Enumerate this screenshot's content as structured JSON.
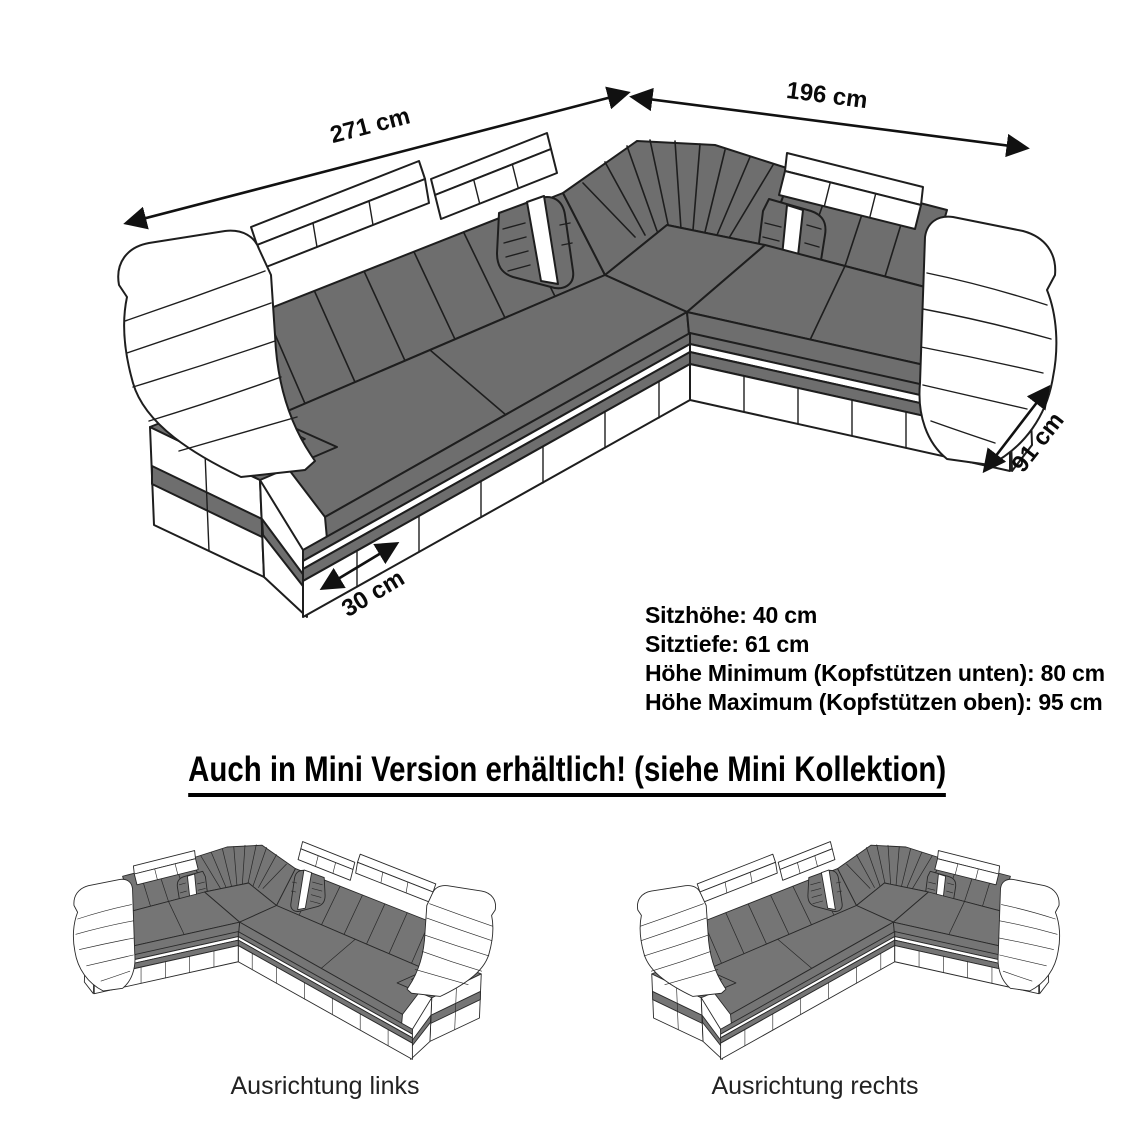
{
  "dimensions": {
    "top_left": "271 cm",
    "top_right": "196 cm",
    "depth_right": "91 cm",
    "base_bottom": "30 cm"
  },
  "specs": {
    "seat_height": "Sitzhöhe: 40 cm",
    "seat_depth": "Sitztiefe: 61 cm",
    "height_min": "Höhe Minimum (Kopfstützen unten): 80 cm",
    "height_max": "Höhe Maximum (Kopfstützen oben): 95 cm"
  },
  "headline": "Auch in Mini Version erhältlich! (siehe Mini Kollektion)",
  "variants": {
    "left": "Ausrichtung links",
    "right": "Ausrichtung rechts"
  },
  "colors": {
    "upholstery_gray": "#6e6e6e",
    "platform_accent_gray": "#b4b4b4",
    "cushion_white": "#ffffff",
    "outline_black": "#1e1e1e"
  }
}
